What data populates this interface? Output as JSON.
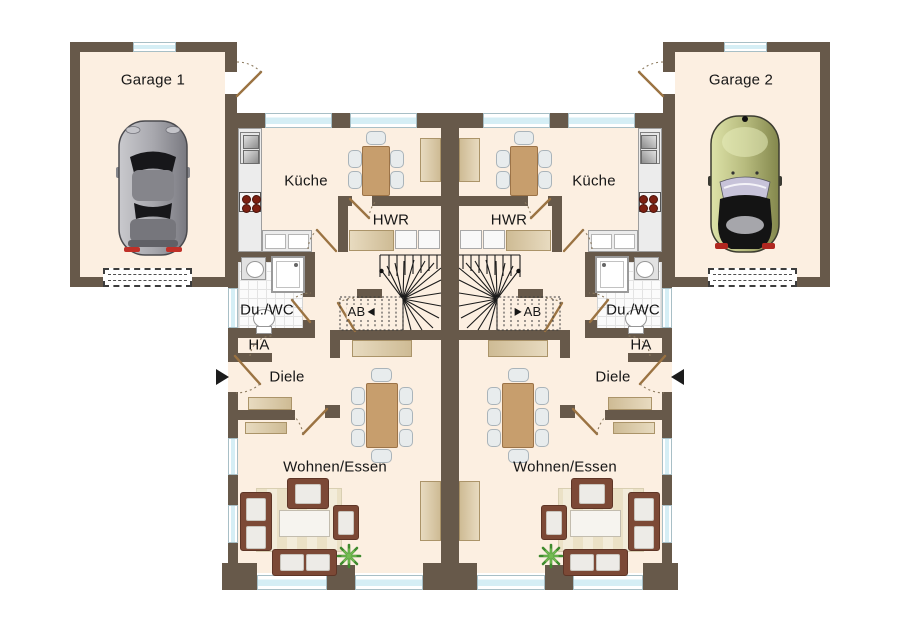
{
  "plan": {
    "units": {
      "left": {
        "garage_label": "Garage 1",
        "kitchen_label": "Küche",
        "utility_room_label": "HWR",
        "shower_wc_label": "Du./WC",
        "house_connection_label": "HA",
        "hallway_label": "Diele",
        "stair_direction_label": "AB",
        "living_dining_label": "Wohnen/Essen"
      },
      "right": {
        "garage_label": "Garage 2",
        "kitchen_label": "Küche",
        "utility_room_label": "HWR",
        "shower_wc_label": "Du./WC",
        "house_connection_label": "HA",
        "hallway_label": "Diele",
        "stair_direction_label": "AB",
        "living_dining_label": "Wohnen/Essen"
      }
    },
    "colors": {
      "wall": "#67594a",
      "floor": "#fcefe1",
      "window_glass": "#d5eef5",
      "wood": "#c79e6d",
      "appliance": "#dbc79e",
      "sofa": "#7c4936",
      "rug": "#eee4cb",
      "plant": "#4f9c38",
      "door_leaf": "#9b7342",
      "stair_lines": "#1a1a1a",
      "car_left_body": "#a2a2a8",
      "car_right_body": "#b7bb7e"
    }
  }
}
